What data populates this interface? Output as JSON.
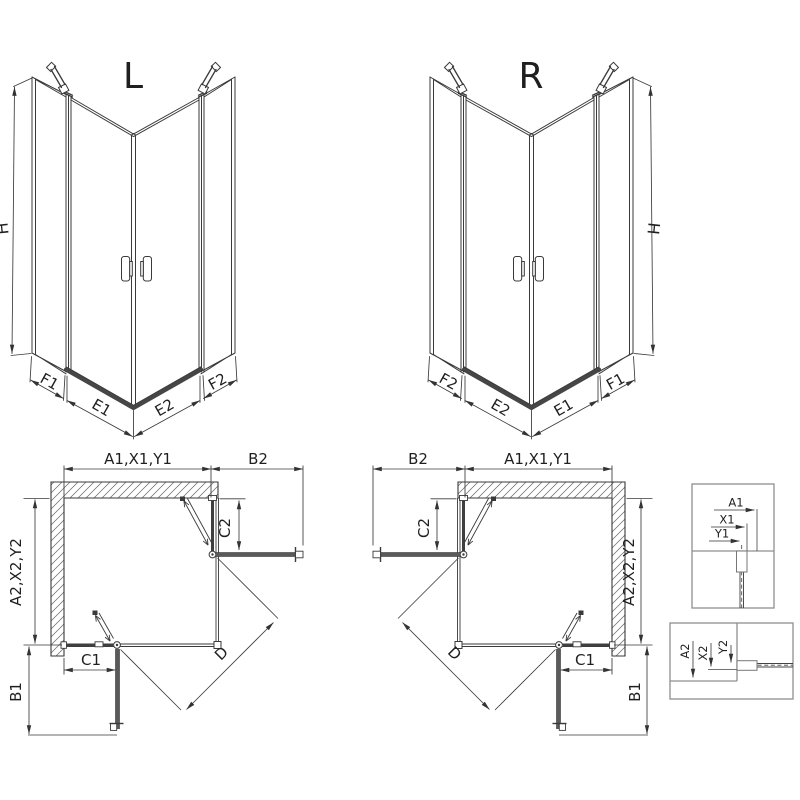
{
  "sheet": {
    "background": "#ffffff",
    "type": "shower-enclosure-installation-diagram"
  },
  "colors": {
    "line": "#3a3a3a",
    "thick_glass": "#464646",
    "open_door": "#5a5a5a",
    "detail_frame": "#8f8f8f",
    "hatch": "#6b6b6b"
  },
  "views": {
    "perspective_left": {
      "label": "L",
      "height": "H",
      "front_left_fixed": "F1",
      "door_left": "E1",
      "door_right": "E2",
      "front_right_fixed": "F2"
    },
    "perspective_right": {
      "label": "R",
      "height": "H",
      "front_left_fixed": "F2",
      "door_left": "E2",
      "door_right": "E1",
      "front_right_fixed": "F1"
    },
    "plan_left": {
      "wall_width": "A1,X1,Y1",
      "door_swing_top": "B2",
      "fixed_panel_top": "C2",
      "wall_depth": "A2,X2,Y2",
      "fixed_panel_side": "C1",
      "door_swing_side": "B1",
      "diagonal_opening": "D"
    },
    "plan_right": {
      "wall_width": "A1,X1,Y1",
      "door_swing_top": "B2",
      "fixed_panel_top": "C2",
      "wall_depth": "A2,X2,Y2",
      "fixed_panel_side": "C1",
      "door_swing_side": "B1",
      "diagonal_opening": "D"
    },
    "detail_top": {
      "dim_outer": "A1",
      "dim_mid": "X1",
      "dim_glass": "Y1"
    },
    "detail_bottom": {
      "dim_outer": "A2",
      "dim_mid": "X2",
      "dim_glass": "Y2"
    }
  }
}
